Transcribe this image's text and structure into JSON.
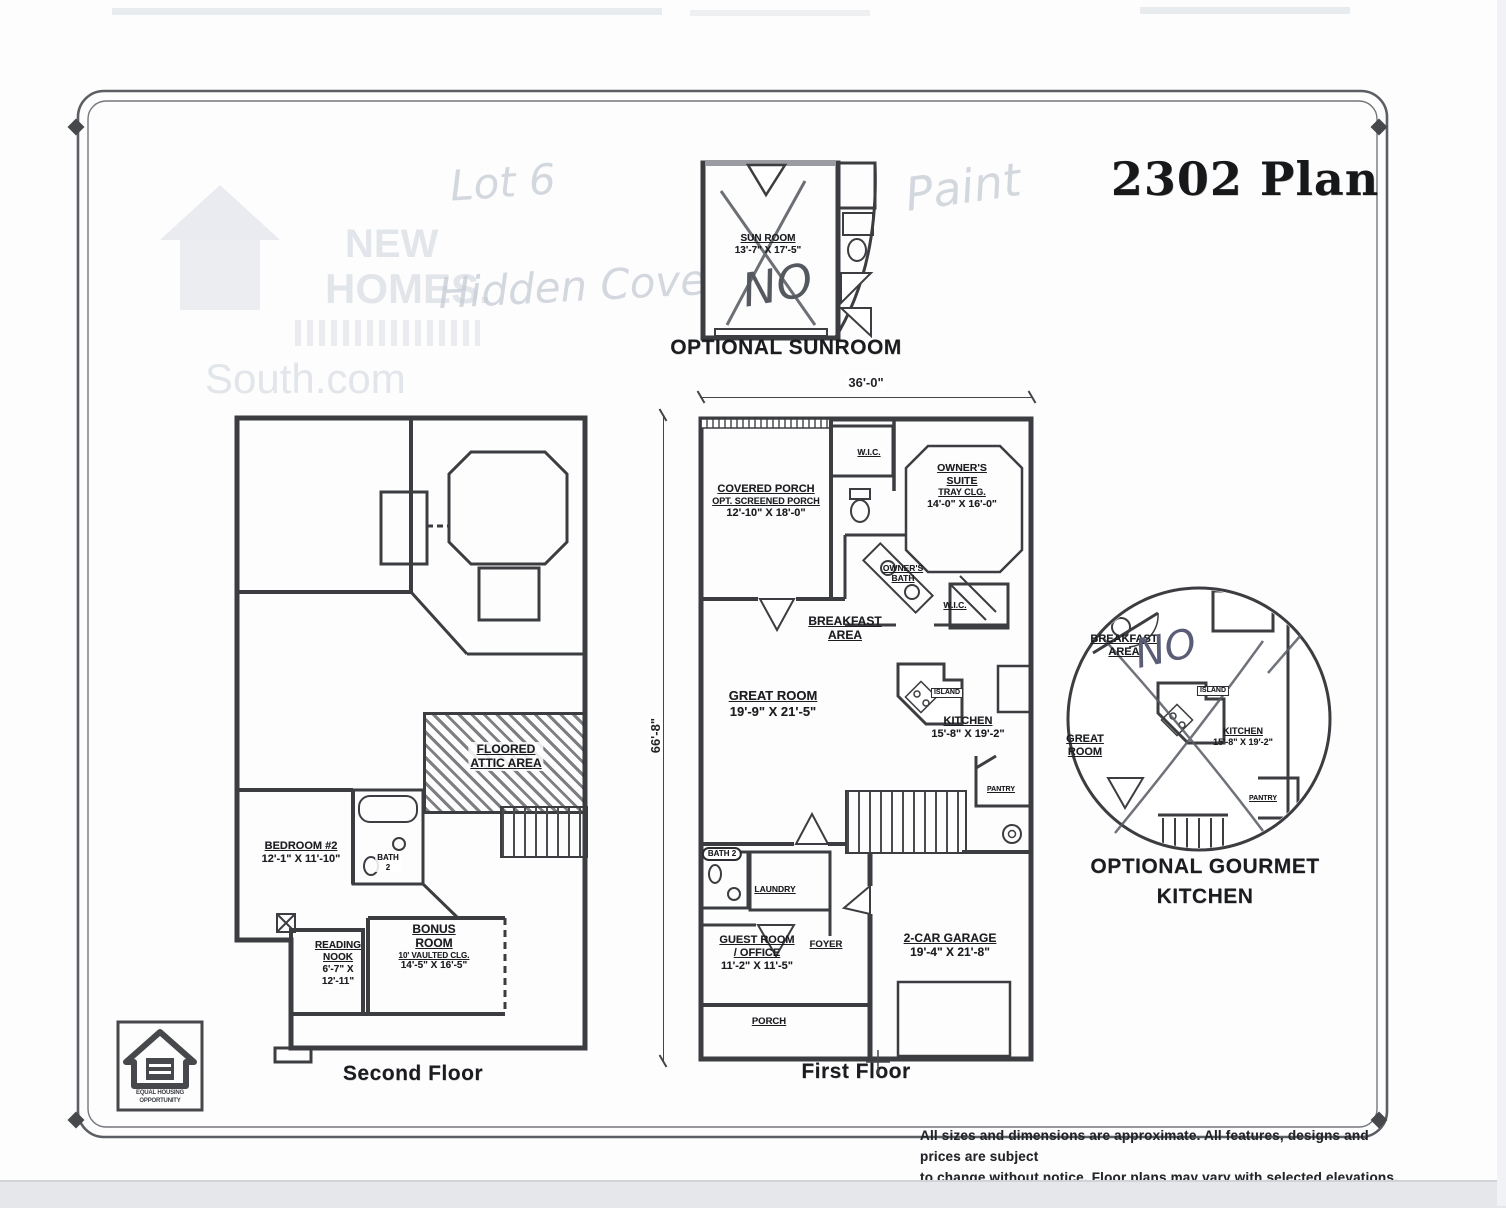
{
  "title": "2302 Plan",
  "sunroom": {
    "caption": "OPTIONAL SUNROOM",
    "label": "SUN ROOM",
    "dims": "13'-7\" X 17'-5\""
  },
  "first_floor": {
    "caption": "First Floor",
    "dim_width": "36'-0\"",
    "dim_height": "66'-8\"",
    "covered_porch": [
      "COVERED PORCH",
      "OPT. SCREENED PORCH",
      "12'-10\" X 18'-0\""
    ],
    "wic_hall": "W.I.C.",
    "owners_suite": [
      "OWNER'S",
      "SUITE",
      "TRAY CLG.",
      "14'-0\" X 16'-0\""
    ],
    "owners_bath": [
      "OWNER'S",
      "BATH"
    ],
    "wic_suite": "W.I.C.",
    "breakfast": [
      "BREAKFAST",
      "AREA"
    ],
    "great_room": [
      "GREAT ROOM",
      "19'-9\" X 21'-5\""
    ],
    "kitchen": [
      "KITCHEN",
      "15'-8\" X 19'-2\""
    ],
    "island": "ISLAND",
    "pantry": "PANTRY",
    "bath2": "BATH 2",
    "laundry": "LAUNDRY",
    "foyer": "FOYER",
    "guest_room": [
      "GUEST ROOM",
      "/ OFFICE",
      "11'-2\" X 11'-5\""
    ],
    "garage": [
      "2-CAR GARAGE",
      "19'-4\" X 21'-8\""
    ],
    "porch": "PORCH"
  },
  "second_floor": {
    "caption": "Second Floor",
    "attic": [
      "FLOORED",
      "ATTIC AREA"
    ],
    "bedroom2": [
      "BEDROOM #2",
      "12'-1\" X 11'-10\""
    ],
    "bath2": [
      "BATH",
      "2"
    ],
    "reading_nook": [
      "READING",
      "NOOK",
      "6'-7\" X",
      "12'-11\""
    ],
    "bonus_room": [
      "BONUS",
      "ROOM",
      "10' VAULTED CLG.",
      "14'-5\" X 16'-5\""
    ]
  },
  "gourmet": {
    "caption_line1": "OPTIONAL GOURMET",
    "caption_line2": "KITCHEN",
    "breakfast": [
      "BREAKFAST",
      "AREA"
    ],
    "great_room": [
      "GREAT",
      "ROOM"
    ],
    "island": "ISLAND",
    "kitchen": [
      "KITCHEN",
      "15'-8\" X 19'-2\""
    ],
    "pantry": "PANTRY"
  },
  "handwriting": {
    "lot": "Lot 6",
    "cove": "Hidden Cove",
    "paint": "Paint",
    "no_sunroom": "NO",
    "no_kitchen": "NO"
  },
  "watermark": {
    "line1": "NEW",
    "line2": "HOMES.",
    "url": "South.com"
  },
  "equal_housing": {
    "line1": "EQUAL HOUSING",
    "line2": "OPPORTUNITY"
  },
  "disclaimer": {
    "line1": "All sizes and dimensions are approximate. All features, designs and prices are subject",
    "line2": "to change without notice.  Floor plans may vary with selected elevations."
  },
  "colors": {
    "ink": "#1c1d20",
    "wall": "#3c3d40",
    "pen": "#53575d",
    "faint_pencil": "#ccd1d9",
    "page_gray": "#e6e7ea"
  }
}
